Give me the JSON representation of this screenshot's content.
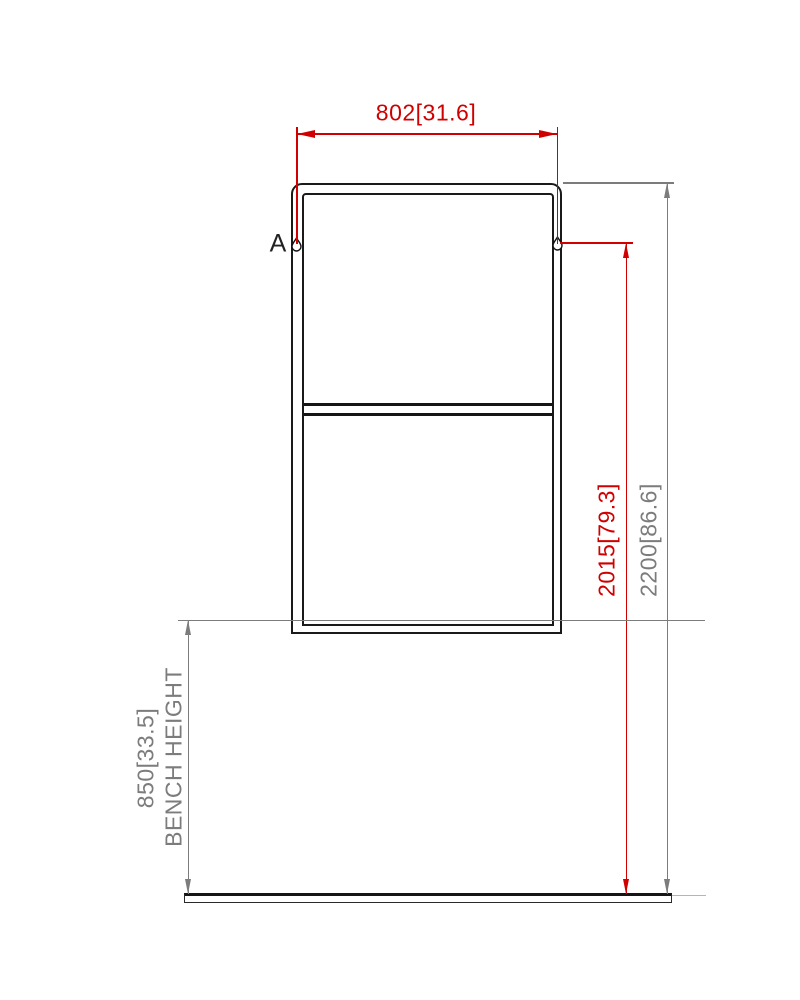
{
  "drawing": {
    "detail": {
      "label": "A"
    },
    "dimensions": {
      "width": {
        "label": "802[31.6]",
        "mm": 802,
        "inches": 31.6,
        "color": "#d00000"
      },
      "keyhole_height": {
        "label": "2015[79.3]",
        "mm": 2015,
        "inches": 79.3,
        "color": "#d00000"
      },
      "overall_height": {
        "label": "2200[86.6]",
        "mm": 2200,
        "inches": 86.6,
        "color": "#7c7c7c"
      },
      "bench_height": {
        "label": "850[33.5]",
        "caption": "BENCH HEIGHT",
        "mm": 850,
        "inches": 33.5,
        "color": "#7c7c7c"
      }
    },
    "colors": {
      "dimension_red": "#d00000",
      "dimension_gray": "#7c7c7c",
      "extension_light_gray": "#b5b5b5",
      "frame_line": "#1a1a1a",
      "background": "#ffffff"
    }
  }
}
